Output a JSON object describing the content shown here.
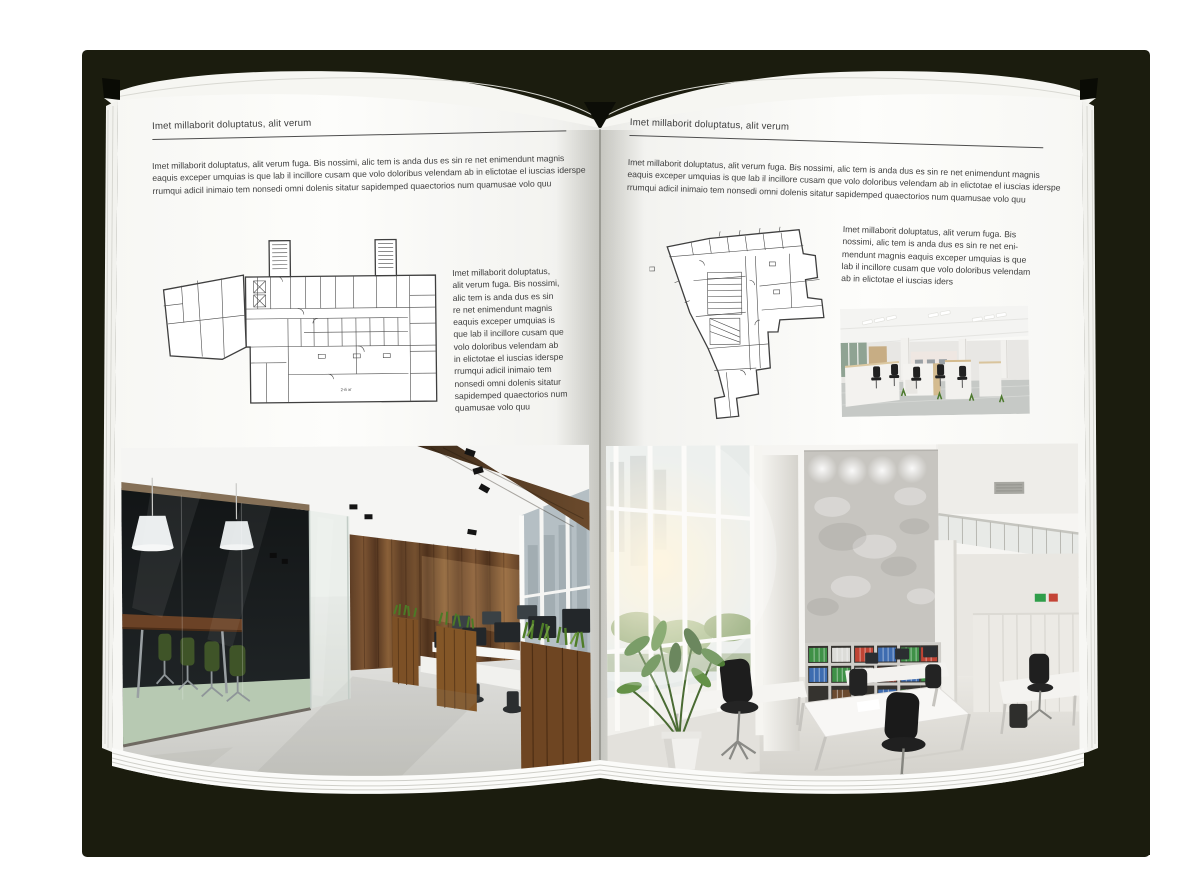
{
  "palette": {
    "canvas": "#ffffff",
    "cover": "#1b1c0e",
    "page": "#fcfcfa",
    "text": "#3d3d3d",
    "rule_line": "#4e4e4e",
    "plan_line": "#3f3f3f",
    "photo_left": {
      "wood_wall": "#7d5533",
      "glass_room": "#17191a",
      "chair_green": "#3f5428",
      "grass": "#4c7a26",
      "floor": "#d9d9d5",
      "beam": "#5a4028"
    },
    "photo_right": {
      "concrete": "#c7c5c0",
      "binder_green": "#3f9147",
      "binder_red": "#c04434",
      "binder_blue": "#3e6cb0",
      "chair_black": "#1d1d1d",
      "plant_green": "#4e7c36"
    },
    "photo_small": {
      "ceiling": "#f4f4f2",
      "wood": "#d4bb8f",
      "chair": "#212121",
      "floor": "#c6c9c6"
    }
  },
  "left_page": {
    "header": "Imet millaborit doluptatus, alit verum",
    "intro_lines": [
      "Imet millaborit doluptatus, alit verum fuga. Bis nossimi, alic tem is anda dus es sin re net enimendunt magnis",
      "eaquis exceper umquias is que lab il incillore cusam que volo doloribus velendam ab in elictotae el iuscias iderspe",
      "rrumqui adicil inimaio tem nonsedi omni dolenis sitatur sapidemped quaectorios num quamusae volo quu"
    ],
    "plan_label": "2-й эт",
    "side_text_lines": [
      "Imet millaborit doluptatus,",
      "alit verum fuga. Bis nossimi,",
      "alic tem is anda dus es sin",
      "re net enimendunt magnis",
      "eaquis exceper umquias is",
      "que lab il incillore cusam que",
      "volo doloribus velendam ab",
      "in elictotae el iuscias iderspe",
      "rrumqui adicil inimaio tem",
      "nonsedi omni dolenis sitatur",
      "sapidemped quaectorios num",
      "quamusae volo quu"
    ]
  },
  "right_page": {
    "header": "Imet millaborit doluptatus, alit verum",
    "intro_lines": [
      "Imet millaborit doluptatus, alit verum fuga. Bis nossimi, alic tem is anda dus es sin re net enimendunt magnis",
      "eaquis exceper umquias is que lab il incillore cusam que volo doloribus velendam ab in elictotae el iuscias iderspe",
      "rrumqui adicil inimaio tem nonsedi omni dolenis sitatur sapidemped quaectorios num quamusae volo quu"
    ],
    "side_text_lines": [
      "Imet millaborit doluptatus, alit verum fuga. Bis",
      "nossimi, alic tem is anda dus es sin re net eni-",
      "mendunt magnis eaquis exceper umquias is que",
      "lab il incillore cusam que volo doloribus velendam",
      "ab in elictotae el iuscias iders"
    ]
  }
}
